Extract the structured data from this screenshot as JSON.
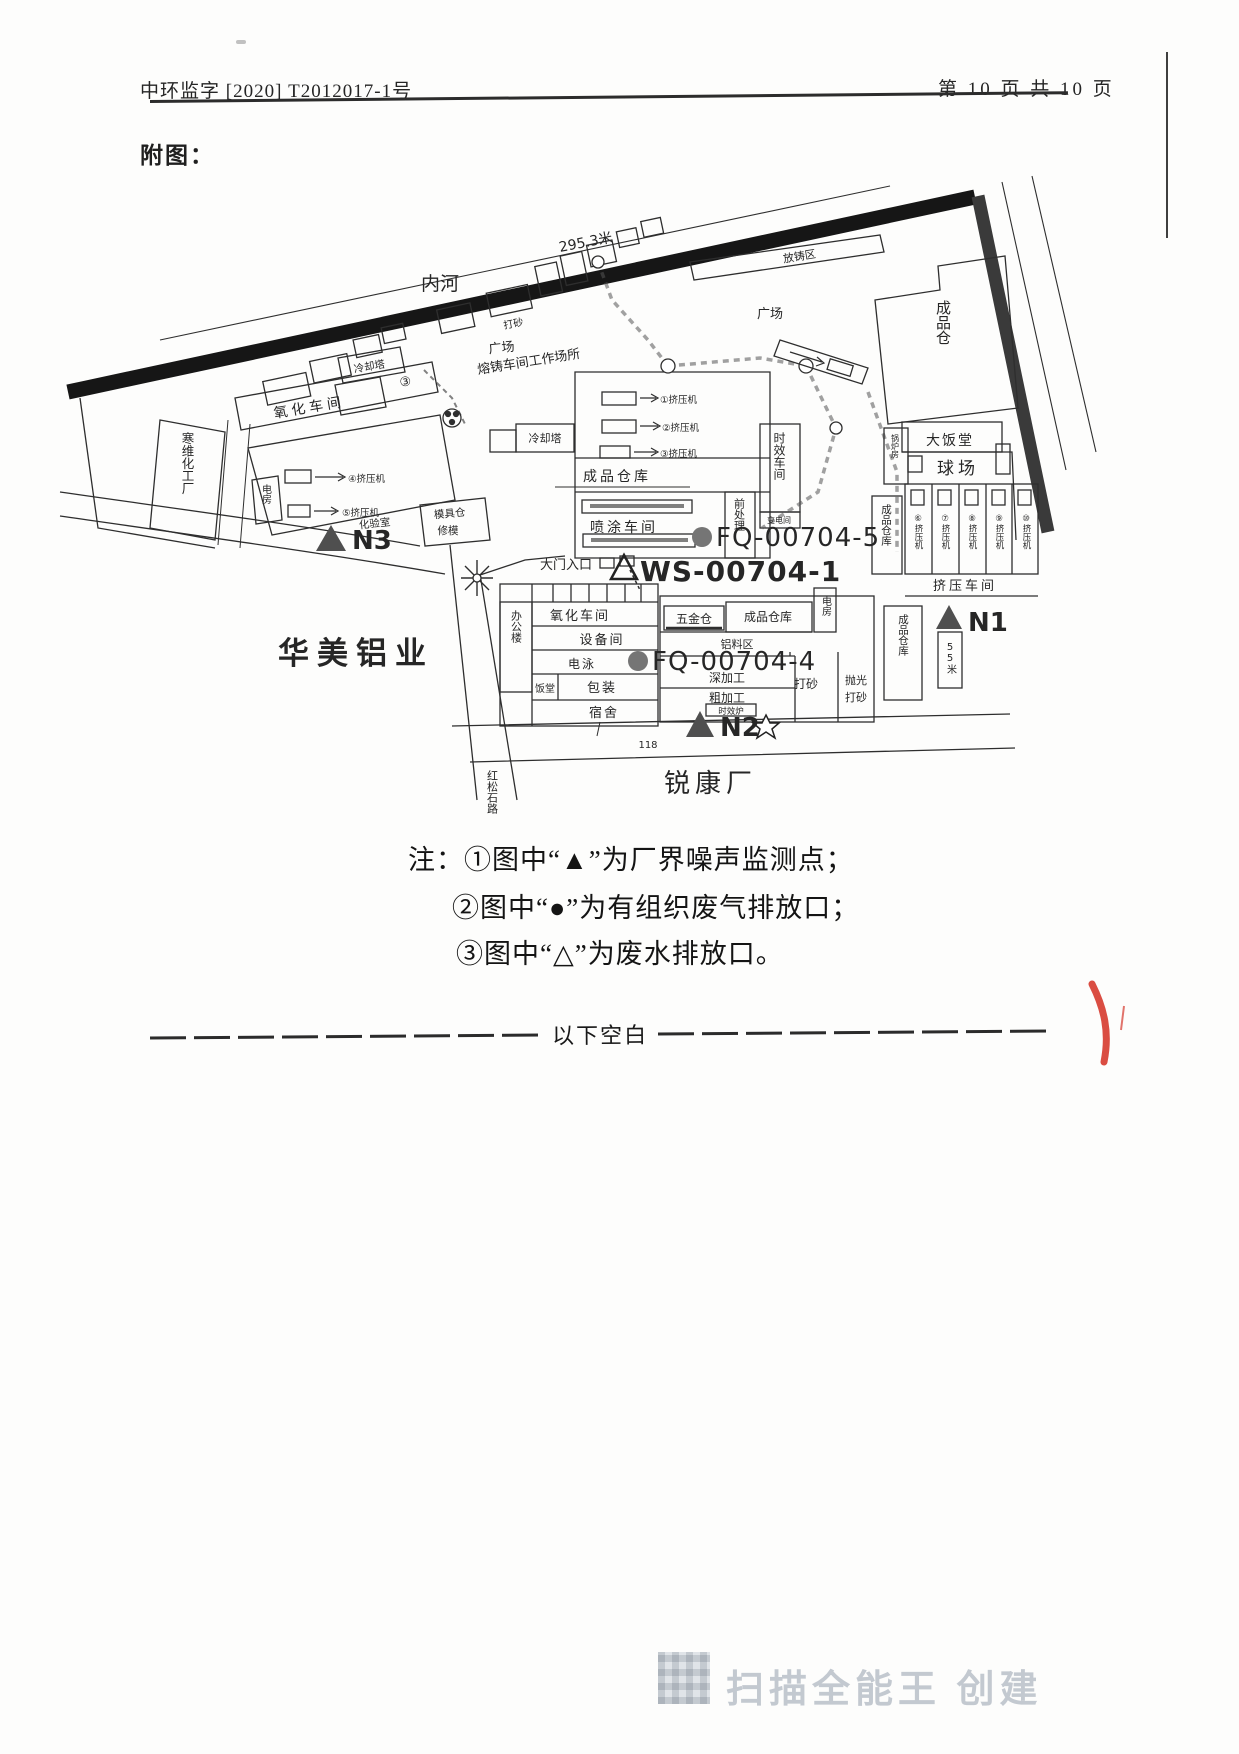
{
  "page": {
    "header_left": "中环监字 [2020] T2012017-1号",
    "header_right": "第 10 页 共 10 页",
    "figure_caption": "附图：",
    "notes": [
      "注：①图中“▲”为厂界噪声监测点；",
      "②图中“●”为有组织废气排放口；",
      "③图中“△”为废水排放口。"
    ],
    "divider_label": "以下空白",
    "watermark": "扫描全能王 创建"
  },
  "map": {
    "labels": {
      "neihe": "内河",
      "riverlen": "295.3米",
      "fangzhuqu": "放铸区",
      "guangchang1": "广场",
      "guangchang2": "广场",
      "rongzhu": "熔铸车间工作场所",
      "dashatop": "打砂",
      "lengque1": "冷却塔",
      "lengque2": "冷却塔",
      "yanghua1": "氧化车间",
      "circ3": "③",
      "hanwei": "寒维化工厂",
      "dianfang1": "电房",
      "dianfang2": "电房",
      "row_a": "④挤压机",
      "row_b": "⑤挤压机",
      "mrow1": "①挤压机",
      "mrow2": "②挤压机",
      "mrow3": "③挤压机",
      "n1": "N1",
      "n2": "N2",
      "n3": "N3",
      "huayanshi": "化验室",
      "mojucang": "模具仓",
      "xiumo": "修模",
      "damen": "大门入口",
      "ws1": "WS-00704-1",
      "fq5": "FQ-00704-5",
      "fq4": "FQ-00704-4",
      "cp_mid": "成品仓库",
      "pentu": "喷涂车间",
      "shixiao": "时效车间",
      "qianchuli": "前处理",
      "biandian": "变电间",
      "chengpincang": "成品仓",
      "dafantang": "大饭堂",
      "qiuchang": "球场",
      "guolufang": "锅炉房",
      "cp_v1": "成品仓库",
      "cp_v2": "成品仓库",
      "jiya": "挤压车间",
      "wushimi": "55米",
      "bangonglou": "办公楼",
      "yanghua2": "氧化车间",
      "shebei": "设备间",
      "dianyong": "电泳",
      "fantang": "饭堂",
      "baozhuang": "包装",
      "sushe": "宿舍",
      "wujincang": "五金仓",
      "cp_r": "成品仓库",
      "lvliao": "铝料区",
      "shenjiagong": "深加工",
      "cujiagong": "粗加工",
      "shixiaolu": "时效炉",
      "dasha": "打砂",
      "paoguang": "抛光",
      "dasha2": "打砂",
      "huamei": "华美铝业",
      "ruikang": "锐康厂",
      "songshilu": "红松石路",
      "dim118": "118"
    },
    "columns": [
      "⑥挤压机",
      "⑦挤压机",
      "⑧挤压机",
      "⑨挤压机",
      "⑩挤压机"
    ]
  },
  "colors": {
    "ink": "#1f1f1f",
    "map_line": "#2e2e2e",
    "band": "#161616",
    "marker_fill": "#4f4f4f",
    "dot_fill": "#757575",
    "red_mark": "#d63a2e",
    "watermark": "#c3c9d0"
  }
}
